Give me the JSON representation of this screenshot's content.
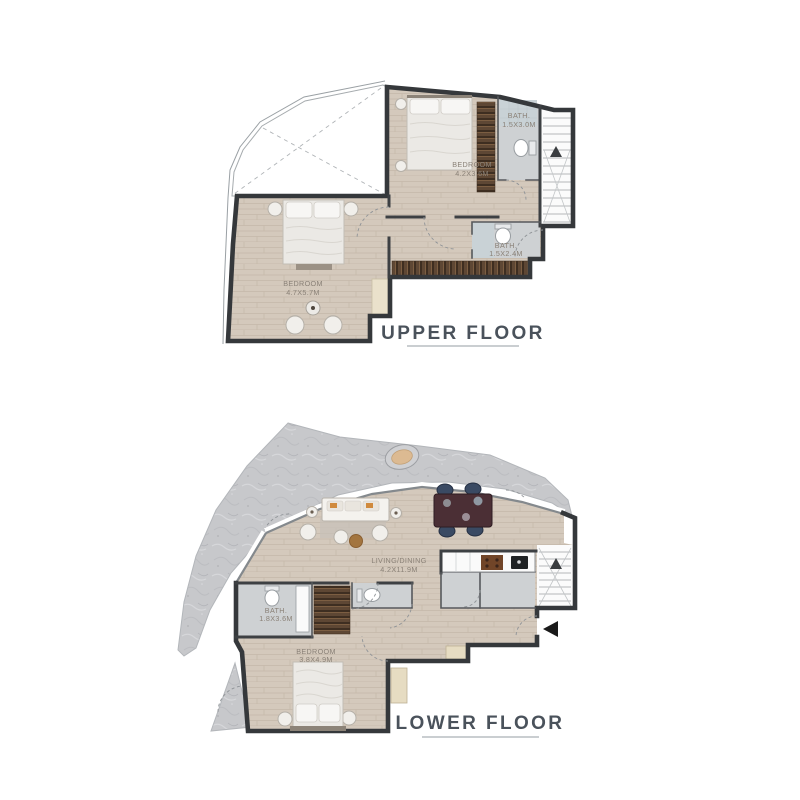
{
  "page": {
    "background": "#ffffff"
  },
  "upper_floor": {
    "title": "UPPER FLOOR",
    "rooms": {
      "bedroom_top": {
        "name": "BEDROOM",
        "dims": "4.2X3.6M"
      },
      "bath_top": {
        "name": "BATH.",
        "dims": "1.5X3.0M"
      },
      "bath_mid": {
        "name": "BATH.",
        "dims": "1.5X2.4M"
      },
      "bedroom_main": {
        "name": "BEDROOM",
        "dims": "4.7X5.7M"
      }
    }
  },
  "lower_floor": {
    "title": "LOWER FLOOR",
    "rooms": {
      "living_dining": {
        "name": "LIVING/DINING",
        "dims": "4.2X11.9M"
      },
      "bath": {
        "name": "BATH.",
        "dims": "1.8X3.6M"
      },
      "bedroom": {
        "name": "BEDROOM",
        "dims": "3.8X4.9M"
      }
    }
  },
  "colors": {
    "wall": "#35383b",
    "wood_floor": "#d4c9bc",
    "bath_floor": "#ced1d3",
    "marble_terrace": "#c7c8cb",
    "wardrobe_wood": "#5e4734",
    "label_text": "#8a8177",
    "title_text": "#4a525b"
  }
}
